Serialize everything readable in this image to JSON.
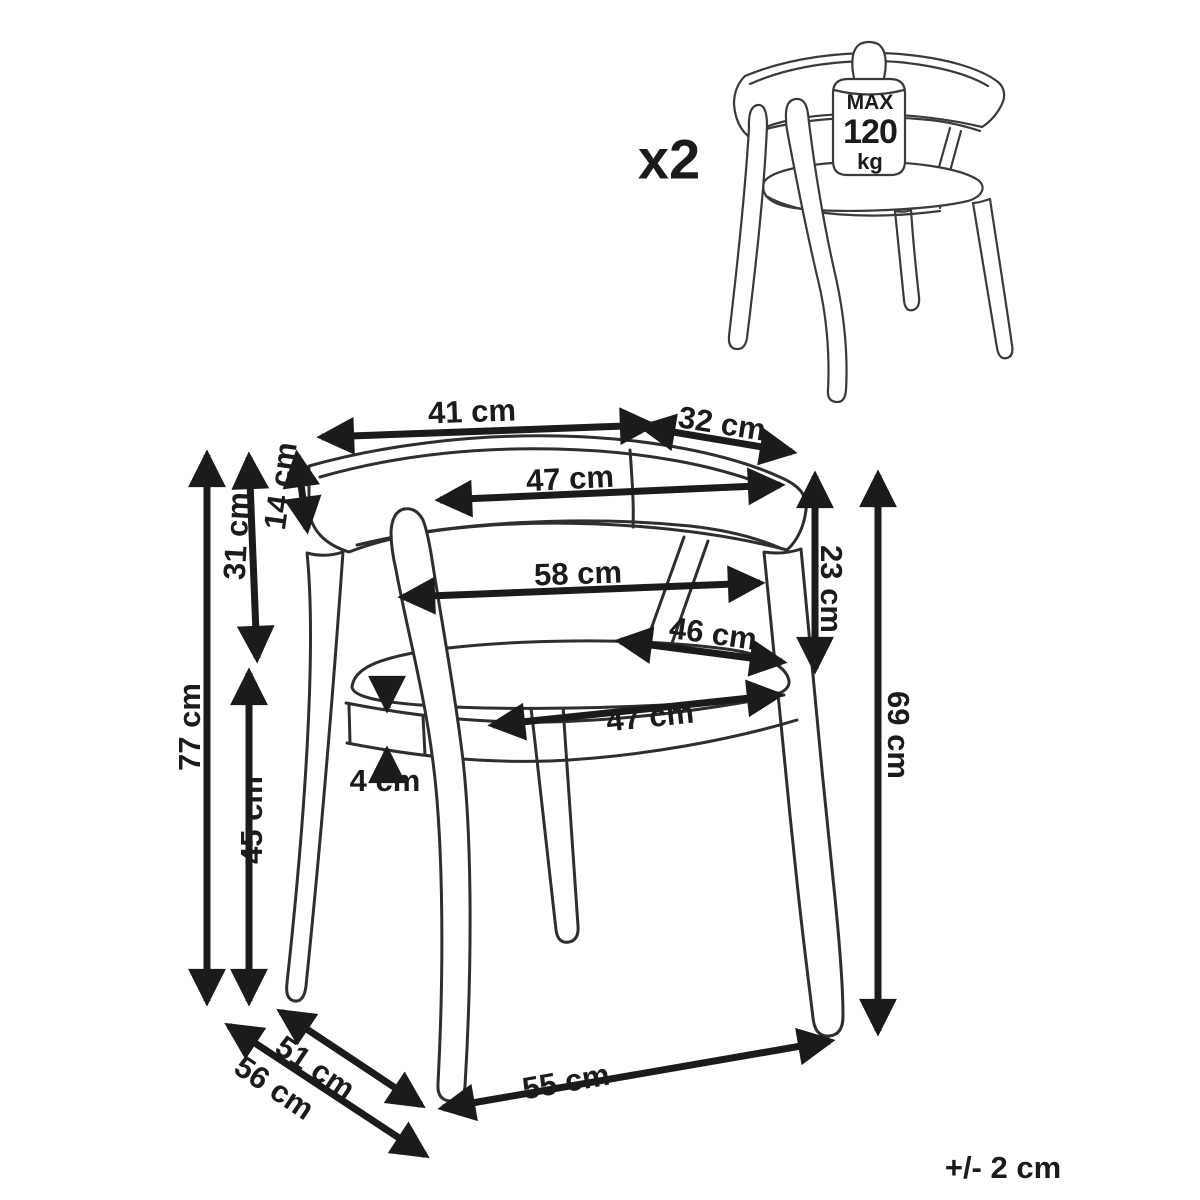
{
  "colors": {
    "background": "#ffffff",
    "chair_line": "#2e2e2e",
    "arrow": "#1b1b1b",
    "text": "#1b1b1b"
  },
  "quantity": {
    "label": "x2"
  },
  "weight_capacity": {
    "prefix": "MAX",
    "value": "120",
    "unit": "kg"
  },
  "tolerance": {
    "label": "+/- 2 cm"
  },
  "dimensions": {
    "top_width_left": "41 cm",
    "top_width_right": "32 cm",
    "backrest_inner_width": "47 cm",
    "armrest_span_width": "58 cm",
    "seat_rear_width": "46 cm",
    "seat_front_width": "47 cm",
    "backrest_band_height": "14 cm",
    "backrest_to_seat": "31 cm",
    "total_height": "77 cm",
    "seat_height": "45 cm",
    "frame_thickness": "4 cm",
    "backrest_drop_right": "23 cm",
    "armrest_height": "69 cm",
    "depth_inner": "51 cm",
    "depth_outer": "56 cm",
    "base_width": "55 cm"
  }
}
